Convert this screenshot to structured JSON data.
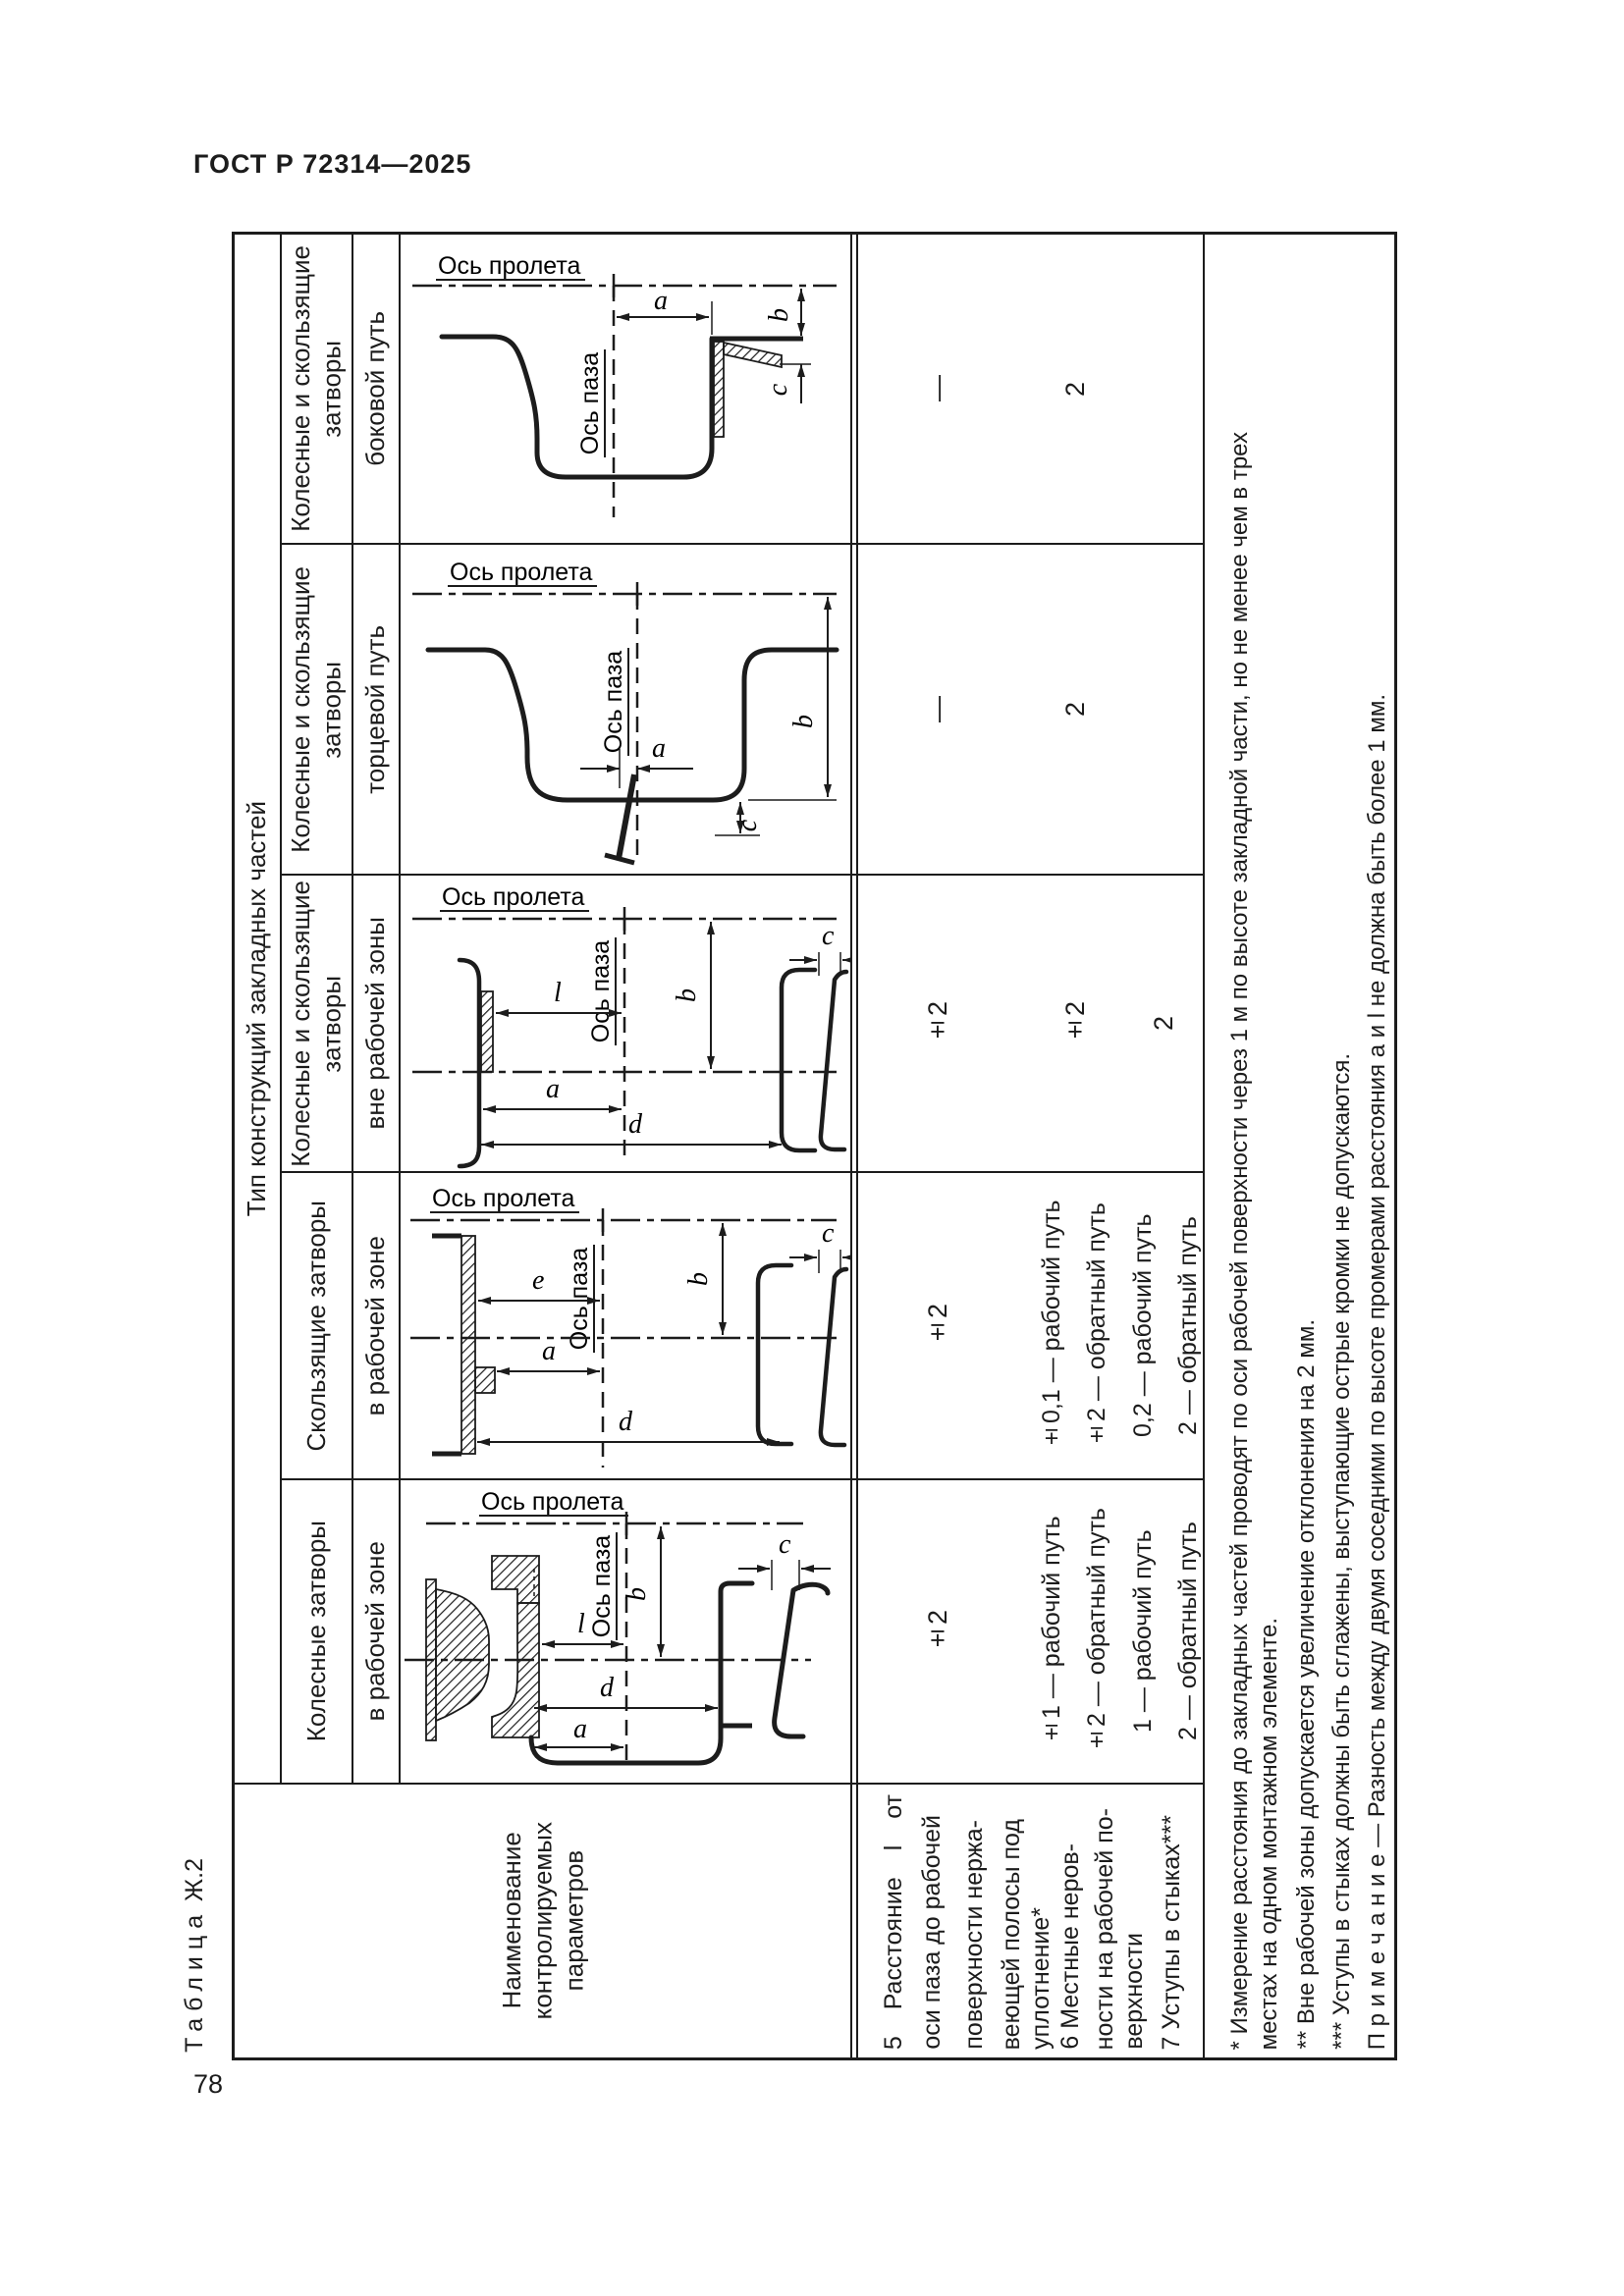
{
  "page": {
    "standard_code": "ГОСТ Р 72314—2025",
    "page_number": "78",
    "table_caption_word": "Таблица",
    "table_caption_number": "Ж.2"
  },
  "table": {
    "group_header": "Тип конструкций закладных частей",
    "name_header": "Наименование\nконтролируемых\nпараметров",
    "bands": [
      {
        "type": "Колесные и скользящие\nзатворы",
        "zone": "боковой путь",
        "row5": "—",
        "row6": "2",
        "row7": ""
      },
      {
        "type": "Колесные и скользящие\nзатворы",
        "zone": "торцевой путь",
        "row5": "—",
        "row6": "2",
        "row7": ""
      },
      {
        "type": "Колесные и скользящие\nзатворы",
        "zone": "вне рабочей зоны",
        "row5": "±2",
        "row6": "±2",
        "row7": "2"
      },
      {
        "type": "Скользящие затворы",
        "zone": "в рабочей зоне",
        "row5": "±2",
        "row6_l1": "±0,1 — рабочий путь",
        "row6_l2": "±2 — обратный путь",
        "row7_l1": "0,2 — рабочий путь",
        "row7_l2": "2 — обратный путь"
      },
      {
        "type": "Колесные затворы",
        "zone": "в рабочей зоне",
        "row5": "±2",
        "row6_l1": "±1 — рабочий путь",
        "row6_l2": "±2 — обратный путь",
        "row7_l1": "1 — рабочий путь",
        "row7_l2": "2 — обратный путь"
      }
    ],
    "param_lines": [
      "5 Расстояние l от",
      "оси паза до рабочей",
      "поверхности нержа-",
      "веющей полосы под",
      "уплотнение*",
      "6 Местные неров-",
      "ности на рабочей по-",
      "верхности",
      "7 Уступы в стыках***"
    ],
    "notes_lines": [
      "* Измерение расстояния до закладных частей проводят по оси рабочей поверхности через 1 м по высоте закладной части, но не менее чем в трех",
      "местах на одном монтажном элементе.",
      "** Вне рабочей зоны допускается увеличение отклонения на 2 мм.",
      "*** Уступы в стыках должны быть сглажены, выступающие острые кромки не допускаются.",
      "П р и м е ч а н и е — Разность между двумя соседними по высоте промерами расстояния a и l не должна быть более 1 мм."
    ],
    "diagram_labels": {
      "axis_span": "Ось пролета",
      "axis_groove": "Ось паза",
      "a": "a",
      "b": "b",
      "c": "c",
      "d": "d",
      "l": "l",
      "e": "e"
    }
  }
}
